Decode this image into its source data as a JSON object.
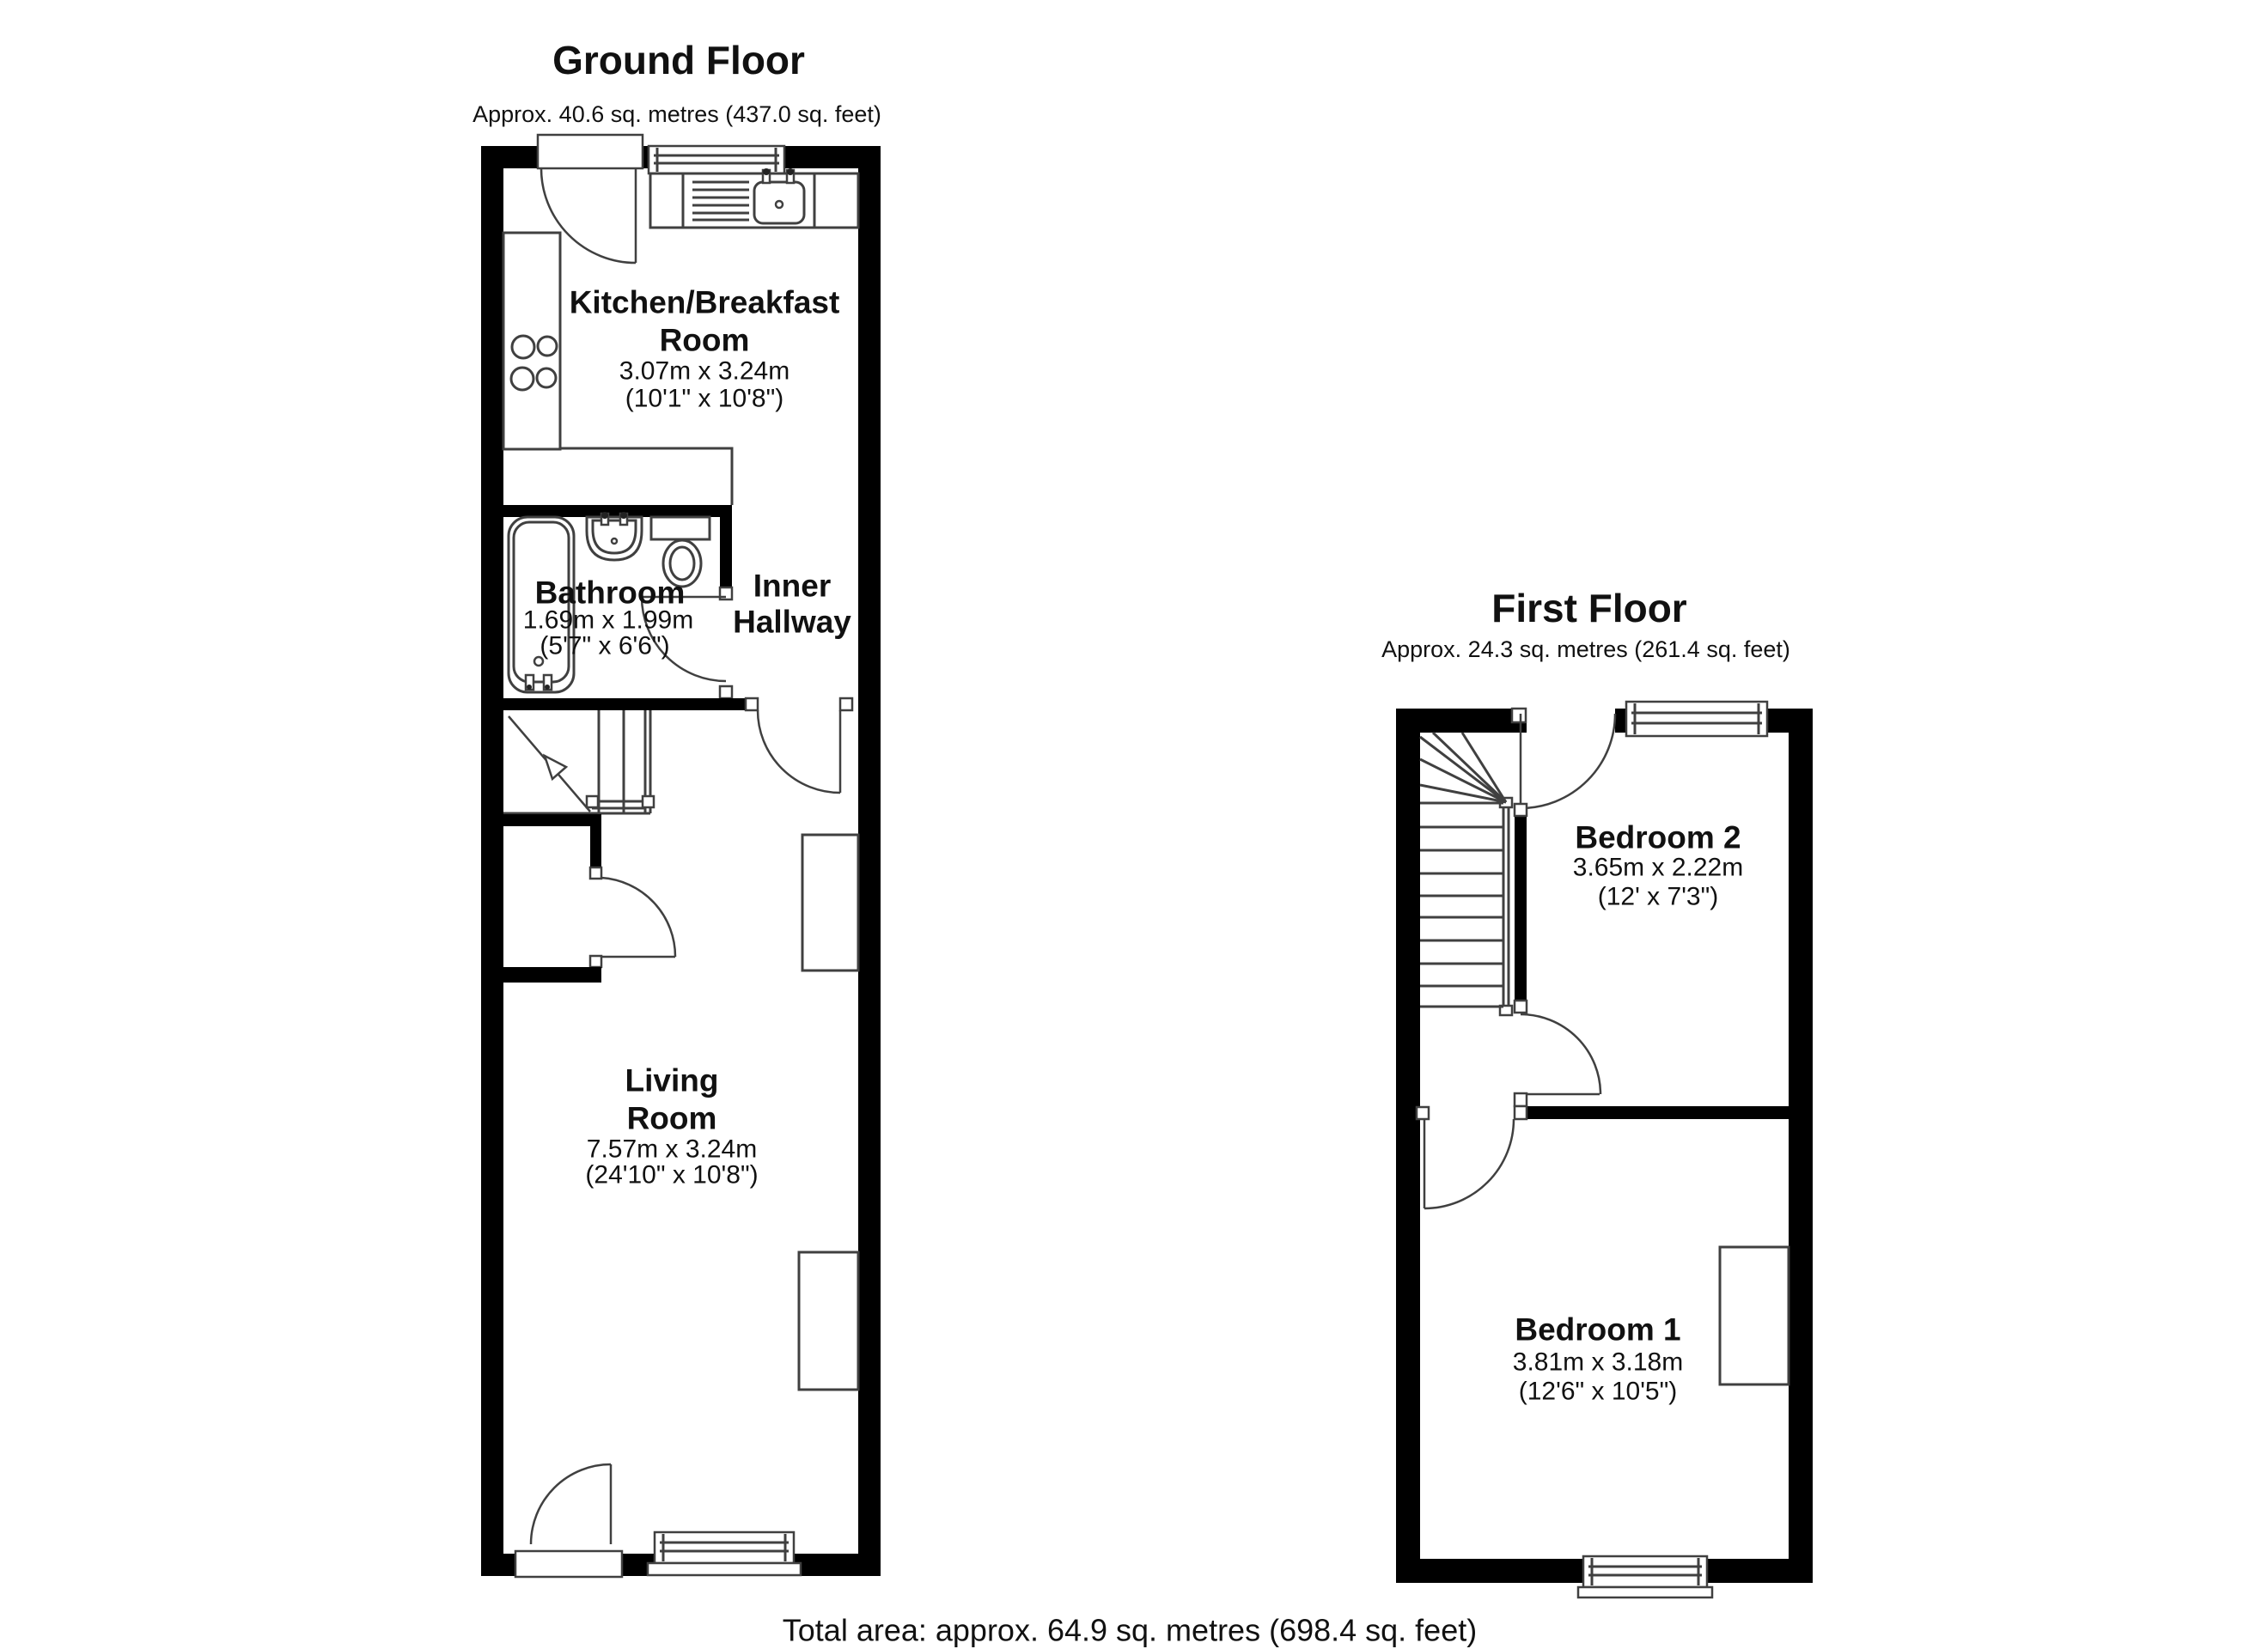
{
  "ground_floor": {
    "title": "Ground Floor",
    "subtitle": "Approx. 40.6 sq. metres (437.0 sq. feet)",
    "kitchen_name_1": "Kitchen/Breakfast",
    "kitchen_name_2": "Room",
    "kitchen_dims_m": "3.07m x 3.24m",
    "kitchen_dims_ft": "(10'1\" x 10'8\")",
    "bathroom_name": "Bathroom",
    "bathroom_dims_m": "1.69m x 1.99m",
    "bathroom_dims_ft": "(5'7\" x 6'6\")",
    "hallway_name_1": "Inner",
    "hallway_name_2": "Hallway",
    "living_name_1": "Living",
    "living_name_2": "Room",
    "living_dims_m": "7.57m x 3.24m",
    "living_dims_ft": "(24'10\" x 10'8\")"
  },
  "first_floor": {
    "title": "First Floor",
    "subtitle": "Approx. 24.3 sq. metres (261.4 sq. feet)",
    "bedroom2_name": "Bedroom 2",
    "bedroom2_dims_m": "3.65m x 2.22m",
    "bedroom2_dims_ft": "(12' x 7'3\")",
    "bedroom1_name": "Bedroom 1",
    "bedroom1_dims_m": "3.81m x 3.18m",
    "bedroom1_dims_ft": "(12'6\" x 10'5\")"
  },
  "footer": {
    "total_area": "Total area: approx. 64.9 sq. metres (698.4 sq. feet)"
  },
  "colors": {
    "wall": "#000000",
    "line": "#404040",
    "text": "#111111",
    "background": "#ffffff"
  }
}
